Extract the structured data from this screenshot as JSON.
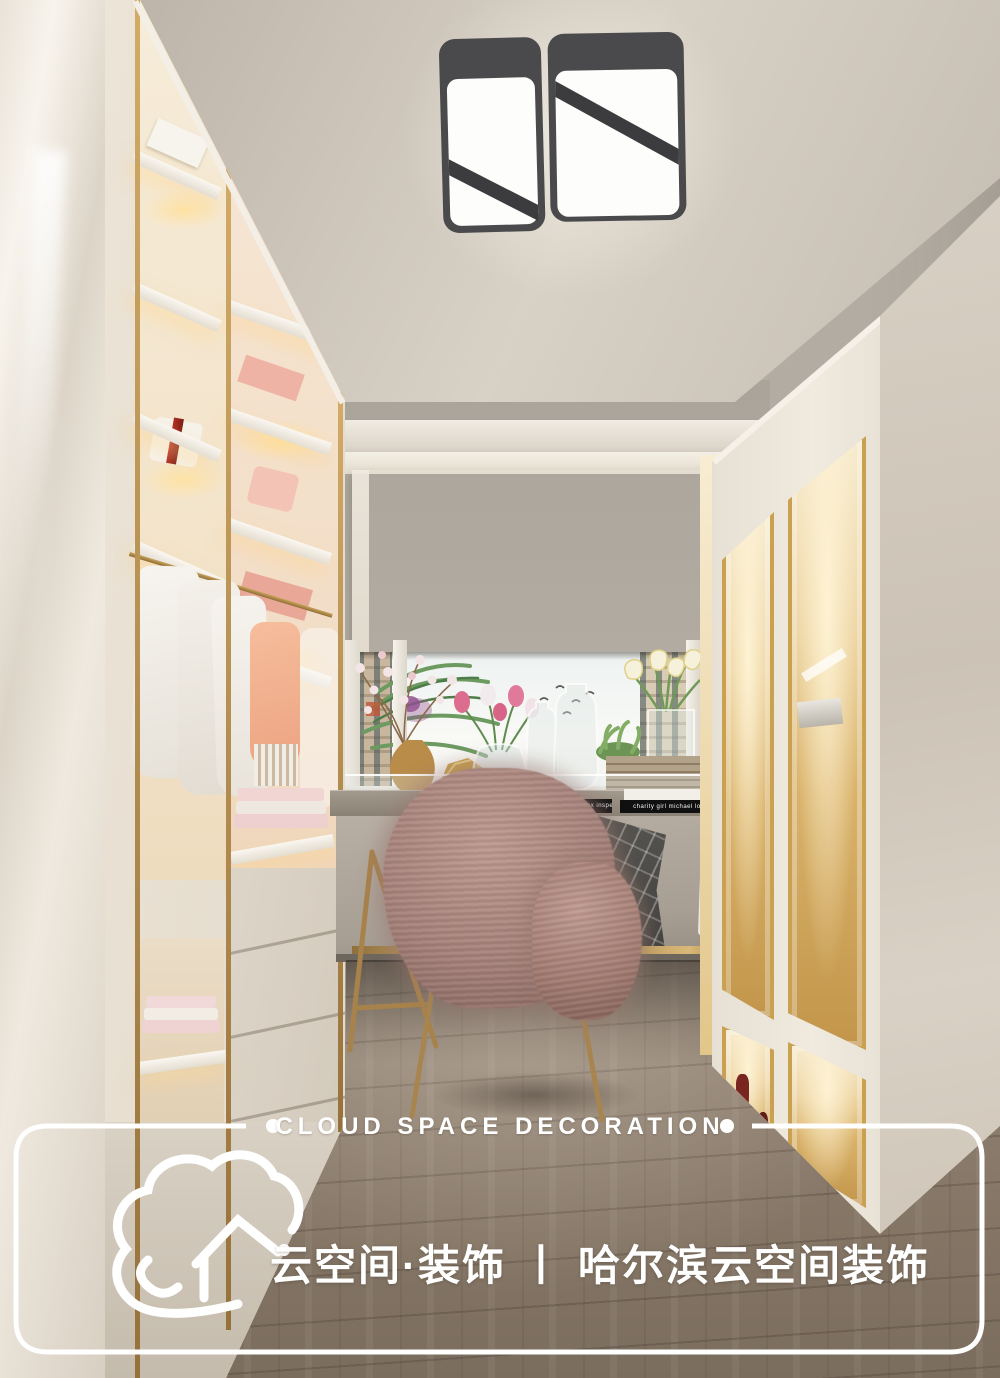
{
  "watermark": {
    "tagline_en": "CLOUD SPACE DECORATION",
    "brand_zh": "云空间·装饰",
    "divider": "丨",
    "company_zh": "哈尔滨云空间装饰",
    "frame_color": "#ffffff"
  },
  "desk_books": {
    "book1_spine": "PETER CAREY   the tax inspector",
    "book2_spine": "charity girl   michael lowenthal"
  },
  "palette": {
    "gold_trim": "#ab8852",
    "wall_gray": "#b3aca2",
    "ceiling": "#cfc8bd",
    "roman_shade": "#d8cbb4",
    "floor_wood": "#8a7b6c",
    "fur_chair": "#a8837b",
    "cabinet_glow": "#e7c88b",
    "watermark_white": "#ffffff"
  }
}
